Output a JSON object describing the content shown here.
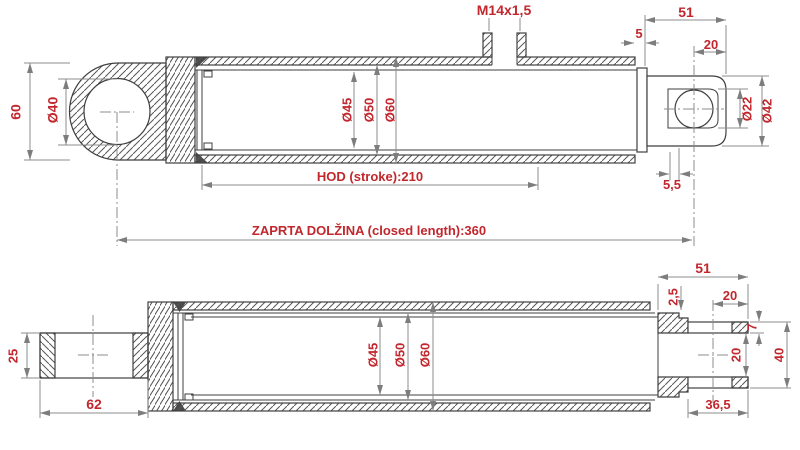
{
  "drawing": {
    "description": "Hydraulic cylinder technical drawing, two section views with dimensions",
    "colors": {
      "dimension_text": "#c1272d",
      "outline": "#3f3f3f",
      "dim_line": "#8c8c8c",
      "background": "#ffffff"
    },
    "top_view": {
      "eye_height": "60",
      "eye_bore": "Ø40",
      "port_thread": "M14x1,5",
      "wall_gap": "5",
      "rod_end_length": "51",
      "pin_to_end": "20",
      "pin_bore": "Ø22",
      "rod_end_diameter": "Ø42",
      "pin_edge": "5,5",
      "bore": "Ø45",
      "mid_diameter": "Ø50",
      "outer_diameter": "Ø60",
      "stroke": "HOD (stroke):210",
      "closed_length": "ZAPRTA DOLŽINA (closed length):360"
    },
    "bottom_view": {
      "tube_width": "25",
      "tube_length": "62",
      "bore": "Ø45",
      "mid_diameter": "Ø50",
      "outer_diameter": "Ø60",
      "rod_end_length": "51",
      "step": "2,5",
      "pin_to_end": "20",
      "wall_thickness": "7",
      "pin_bore": "20",
      "tube_outer": "40",
      "tube_offset": "36,5"
    }
  }
}
